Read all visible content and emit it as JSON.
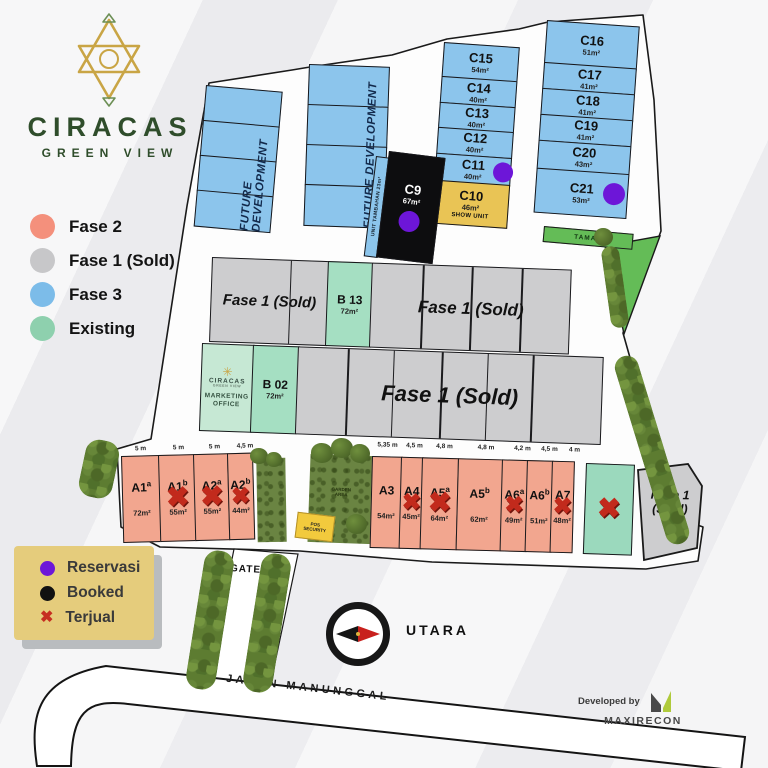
{
  "brand": {
    "name": "CIRACAS",
    "tagline": "GREEN VIEW"
  },
  "legend_phases": {
    "items": [
      {
        "label": "Fase 2",
        "color": "#f4907c"
      },
      {
        "label": "Fase 1 (Sold)",
        "color": "#c7c7c9"
      },
      {
        "label": "Fase 3",
        "color": "#7cbce9"
      },
      {
        "label": "Existing",
        "color": "#8ed0ae"
      }
    ]
  },
  "legend_status": {
    "items": [
      {
        "label": "Reservasi",
        "symbol": "dot",
        "color": "#6d16d8"
      },
      {
        "label": "Booked",
        "symbol": "dot",
        "color": "#111111"
      },
      {
        "label": "Terjual",
        "symbol": "x",
        "color": "#c62e21"
      }
    ]
  },
  "future_development": {
    "label": "FUTURE DEVELOPMENT"
  },
  "labels": {
    "fase1_sold": "Fase 1 (Sold)",
    "fase1_line1": "Fase 1",
    "fase1_line2": "(Sold)",
    "taman": "TAMAN",
    "gate": "GATE",
    "show_unit": "SHOW UNIT",
    "unit_tambahan": "UNIT TAMBAHAN 23m²",
    "garden_line1": "GARDEN",
    "garden_line2": "AREA"
  },
  "plots": {
    "c_left": [
      {
        "id": "C15",
        "area": "54m²"
      },
      {
        "id": "C14",
        "area": "40m²"
      },
      {
        "id": "C13",
        "area": "40m²"
      },
      {
        "id": "C12",
        "area": "40m²"
      },
      {
        "id": "C11",
        "area": "40m²",
        "marker": "reservasi"
      },
      {
        "id": "C10",
        "area": "46m²",
        "note": "SHOW UNIT"
      }
    ],
    "c_right": [
      {
        "id": "C16",
        "area": "51m²"
      },
      {
        "id": "C17",
        "area": "41m²"
      },
      {
        "id": "C18",
        "area": "41m²"
      },
      {
        "id": "C19",
        "area": "41m²"
      },
      {
        "id": "C20",
        "area": "43m²"
      },
      {
        "id": "C21",
        "area": "53m²",
        "marker": "reservasi"
      }
    ],
    "c9": {
      "id": "C9",
      "area": "67m²",
      "status": "booked",
      "marker": "reservasi"
    },
    "b13": {
      "id": "B 13",
      "area": "72m²"
    },
    "b02": {
      "id": "B 02",
      "area": "72m²"
    },
    "a_left": [
      {
        "id": "A1",
        "sup": "a",
        "area": "72m²",
        "width": "5 m"
      },
      {
        "id": "A1",
        "sup": "b",
        "area": "55m²",
        "width": "5 m",
        "status": "terjual"
      },
      {
        "id": "A2",
        "sup": "a",
        "area": "55m²",
        "width": "5 m",
        "status": "terjual"
      },
      {
        "id": "A2",
        "sup": "b",
        "area": "44m²",
        "width": "4,5 m",
        "status": "terjual"
      }
    ],
    "a_right": [
      {
        "id": "A3",
        "area": "54m²",
        "width": "5,35 m"
      },
      {
        "id": "A4",
        "area": "45m²",
        "width": "4,5 m",
        "status": "terjual"
      },
      {
        "id": "A5",
        "sup": "a",
        "area": "64m²",
        "width": "4,8 m",
        "status": "terjual"
      },
      {
        "id": "A5",
        "sup": "b",
        "area": "62m²",
        "width": "4,8 m"
      },
      {
        "id": "A6",
        "sup": "a",
        "area": "49m²",
        "width": "4,2 m",
        "status": "terjual"
      },
      {
        "id": "A6",
        "sup": "b",
        "area": "51m²",
        "width": "4,5 m"
      },
      {
        "id": "A7",
        "area": "48m²",
        "width": "4 m",
        "status": "terjual"
      }
    ],
    "a8": {
      "id": "A8",
      "status": "terjual"
    }
  },
  "measurements": {
    "a_left": [
      "5 m",
      "5 m",
      "5 m",
      "4,5 m"
    ],
    "a_right": [
      "5,35 m",
      "4,5 m",
      "4,8 m",
      "4,8 m",
      "4,2 m",
      "4,5 m",
      "4 m"
    ]
  },
  "marketing_office": {
    "brand": "CIRACAS",
    "sub": "GREEN VIEW",
    "line1": "MARKETING",
    "line2": "OFFICE"
  },
  "security": {
    "line1": "POS",
    "line2": "SECURITY"
  },
  "compass": {
    "label": "UTARA"
  },
  "road": {
    "name": "JALAN MANUNGGAL"
  },
  "developer": {
    "prefix": "Developed by",
    "name": "MAXIRECON"
  }
}
